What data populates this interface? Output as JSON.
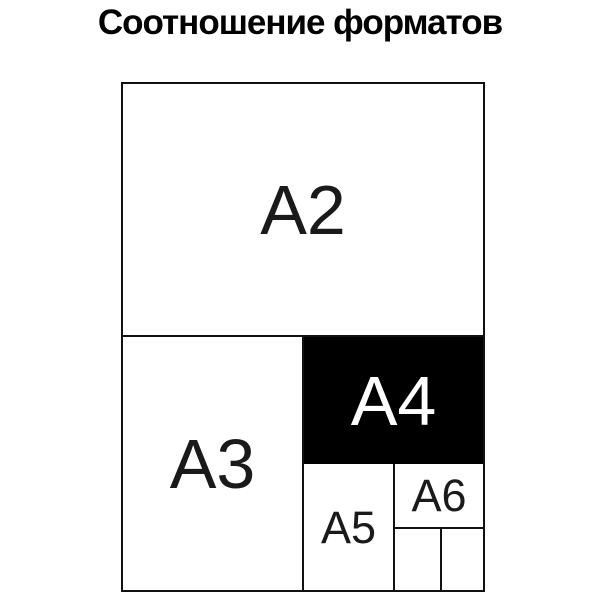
{
  "title": "Соотношение форматов",
  "colors": {
    "background": "#ffffff",
    "line": "#111111",
    "title_text": "#000000",
    "label_text": "#1a1a1a",
    "highlight_fill": "#000000",
    "highlight_text": "#ffffff"
  },
  "diagram": {
    "description": "Nested rectangles showing relative sizes of ISO A-series paper formats",
    "formats": [
      {
        "id": "A2",
        "label": "A2",
        "highlighted": false
      },
      {
        "id": "A3",
        "label": "A3",
        "highlighted": false
      },
      {
        "id": "A4",
        "label": "A4",
        "highlighted": true
      },
      {
        "id": "A5",
        "label": "A5",
        "highlighted": false
      },
      {
        "id": "A6",
        "label": "A6",
        "highlighted": false
      },
      {
        "id": "A7-left",
        "label": "",
        "highlighted": false
      },
      {
        "id": "A7-right",
        "label": "",
        "highlighted": false
      }
    ]
  }
}
